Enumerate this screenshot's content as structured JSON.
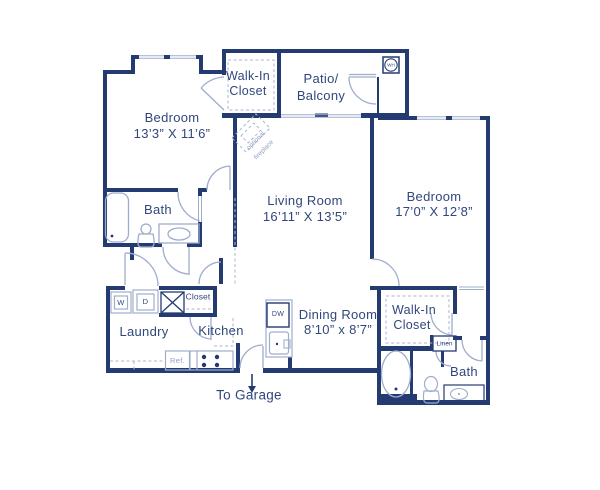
{
  "plan": {
    "rooms": {
      "bedroom1": {
        "name": "Bedroom",
        "dims": "13’3” X 11’6”"
      },
      "bedroom2": {
        "name": "Bedroom",
        "dims": "17’0” X 12’8”"
      },
      "living": {
        "name": "Living Room",
        "dims": "16’11” X 13’5”"
      },
      "dining": {
        "name": "Dining Room",
        "dims": "8’10” x 8’7”"
      },
      "patio": {
        "line1": "Patio/",
        "line2": "Balcony"
      },
      "wic1": {
        "line1": "Walk-In",
        "line2": "Closet"
      },
      "wic2": {
        "line1": "Walk-In",
        "line2": "Closet"
      },
      "bath1": {
        "name": "Bath"
      },
      "bath2": {
        "name": "Bath"
      },
      "laundry": {
        "name": "Laundry"
      },
      "kitchen": {
        "name": "Kitchen"
      },
      "closet": {
        "name": "Closet"
      },
      "linen": {
        "name": "Linen"
      }
    },
    "appliances": {
      "washer": "W",
      "dryer": "D",
      "refrigerator": "Ref.",
      "dishwasher": "DW",
      "water_heater": "WH"
    },
    "annotations": {
      "to_garage": "To Garage",
      "fireplace_line1": "optional",
      "fireplace_line2": "fireplace"
    },
    "colors": {
      "wall": "#243b72",
      "accent_light": "#9fadcc",
      "text": "#31477c",
      "text_light": "#8fa0c4"
    }
  }
}
